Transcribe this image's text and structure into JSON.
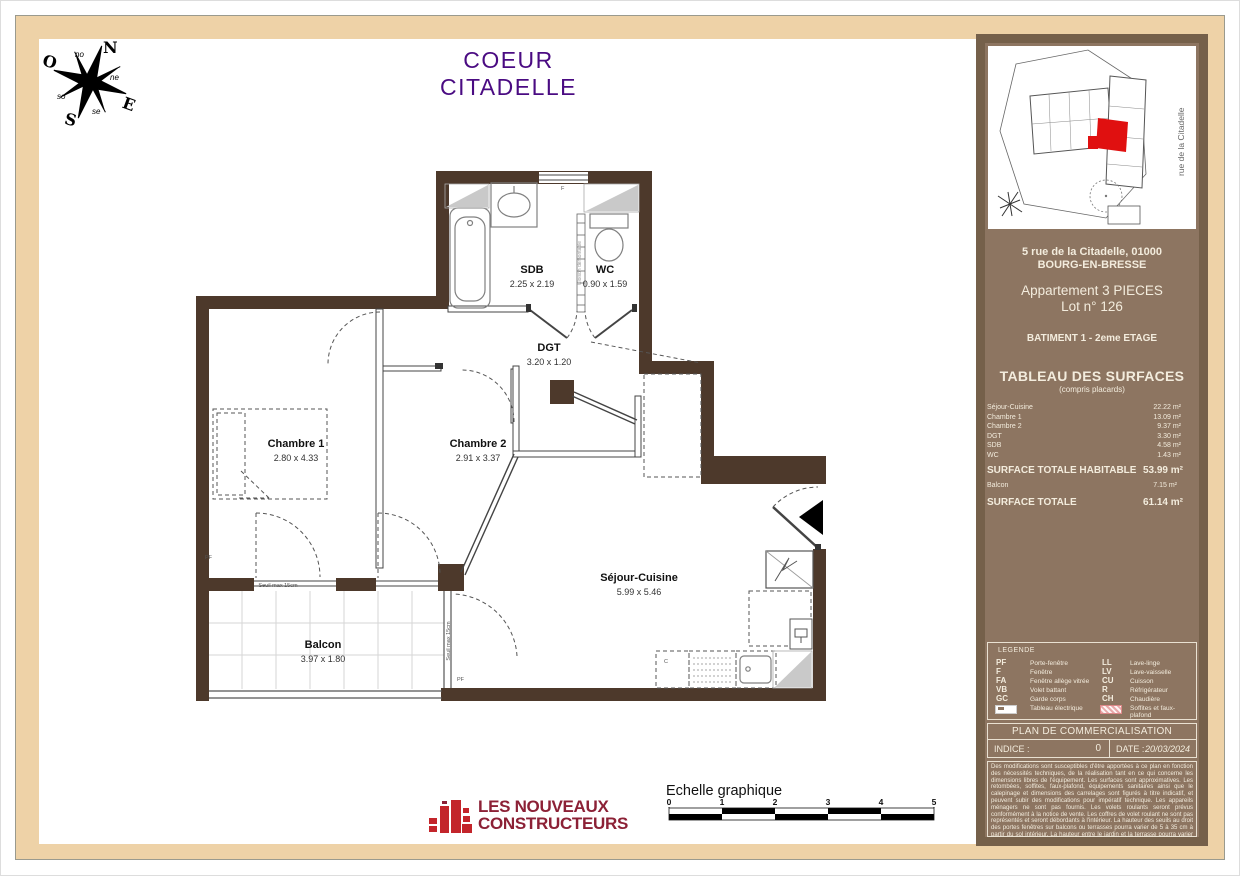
{
  "title": "COEUR CITADELLE",
  "compass": {
    "n": "N",
    "e": "E",
    "s": "S",
    "o": "O",
    "ne": "ne",
    "no": "no",
    "se": "se",
    "so": "so"
  },
  "plan": {
    "rooms": [
      {
        "name": "SDB",
        "dims": "2.25 x 2.19"
      },
      {
        "name": "WC",
        "dims": "0.90 x 1.59"
      },
      {
        "name": "DGT",
        "dims": "3.20 x 1.20"
      },
      {
        "name": "Chambre 1",
        "dims": "2.80 x 4.33"
      },
      {
        "name": "Chambre 2",
        "dims": "2.91 x 3.37"
      },
      {
        "name": "Séjour-Cuisine",
        "dims": "5.99 x 5.46"
      },
      {
        "name": "Balcon",
        "dims": "3.97 x 1.80"
      }
    ],
    "annotations": {
      "seuil_h": "Seuil max 15cm",
      "seuil_v": "Seuil max 15cm",
      "cloison": "Cloison démontable",
      "pf1": "PF",
      "pf2": "PF",
      "f": "F",
      "c": "C"
    }
  },
  "sidebar": {
    "street_label": "rue de la Citadelle",
    "address1": "5 rue de la Citadelle, 01000",
    "address2": "BOURG-EN-BRESSE",
    "apartment": "Appartement 3 PIECES",
    "lot": "Lot n° 126",
    "building": "BATIMENT 1 - 2eme ETAGE",
    "surfaces_title": "TABLEAU DES SURFACES",
    "surfaces_subtitle": "(compris placards)",
    "rows": [
      {
        "label": "Séjour-Cuisine",
        "value": "22.22 m²"
      },
      {
        "label": "Chambre 1",
        "value": "13.09 m²"
      },
      {
        "label": "Chambre 2",
        "value": "9.37 m²"
      },
      {
        "label": "DGT",
        "value": "3.30 m²"
      },
      {
        "label": "SDB",
        "value": "4.58 m²"
      },
      {
        "label": "WC",
        "value": "1.43 m²"
      }
    ],
    "total_habitable_label": "SURFACE TOTALE HABITABLE",
    "total_habitable_value": "53.99 m²",
    "balcon_label": "Balcon",
    "balcon_value": "7.15 m²",
    "total_label": "SURFACE TOTALE",
    "total_value": "61.14 m²",
    "legend_title": "LEGENDE",
    "legend_left": [
      {
        "abbr": "PF",
        "label": "Porte-fenêtre"
      },
      {
        "abbr": "F",
        "label": "Fenêtre"
      },
      {
        "abbr": "FA",
        "label": "Fenêtre allège vitrée"
      },
      {
        "abbr": "VB",
        "label": "Volet battant"
      },
      {
        "abbr": "GC",
        "label": "Garde corps"
      },
      {
        "abbr": "",
        "label": "Tableau électrique"
      }
    ],
    "legend_right": [
      {
        "abbr": "LL",
        "label": "Lave-linge"
      },
      {
        "abbr": "LV",
        "label": "Lave-vaisselle"
      },
      {
        "abbr": "CU",
        "label": "Cuisson"
      },
      {
        "abbr": "R",
        "label": "Réfrigérateur"
      },
      {
        "abbr": "CH",
        "label": "Chaudière"
      },
      {
        "abbr": "",
        "label": "Soffites et faux-plafond"
      }
    ],
    "plan_box_title": "PLAN DE COMMERCIALISATION",
    "indice_label": "INDICE :",
    "indice_value": "0",
    "date_label": "DATE :",
    "date_value": "20/03/2024",
    "disclaimer": "Des modifications sont susceptibles d'être apportées à ce plan en fonction des nécessités techniques, de la réalisation tant en ce qui concerne les dimensions libres de l'équipement. Les surfaces sont approximatives. Les retombées, soffites, faux-plafond, équipements sanitaires ainsi que le calepinage et dimensions des carrelages sont figurés à titre indicatif, et peuvent subir des modifications pour impératif technique. Les appareils ménagers ne sont pas fournis. Les volets roulants seront prévus conformément à la notice de vente. Les coffres de volet roulant ne sont pas représentés et seront débordants à l'intérieur. La hauteur des seuils au droit des portes fenêtres sur balcons ou terrasses pourra varier de 5 à 35 cm à partir du sol intérieur. La hauteur entre le jardin et la terrasse pourra varier entre 0 et 60 cm. Les jardins ne seront pas nécessairement plats et pourront comporter des talus et des pentes."
  },
  "footer": {
    "logo_line1": "LES NOUVEAUX",
    "logo_line2": "CONSTRUCTEURS",
    "scale_title": "Echelle graphique",
    "scale_ticks": [
      "0",
      "1",
      "2",
      "3",
      "4",
      "5"
    ]
  }
}
